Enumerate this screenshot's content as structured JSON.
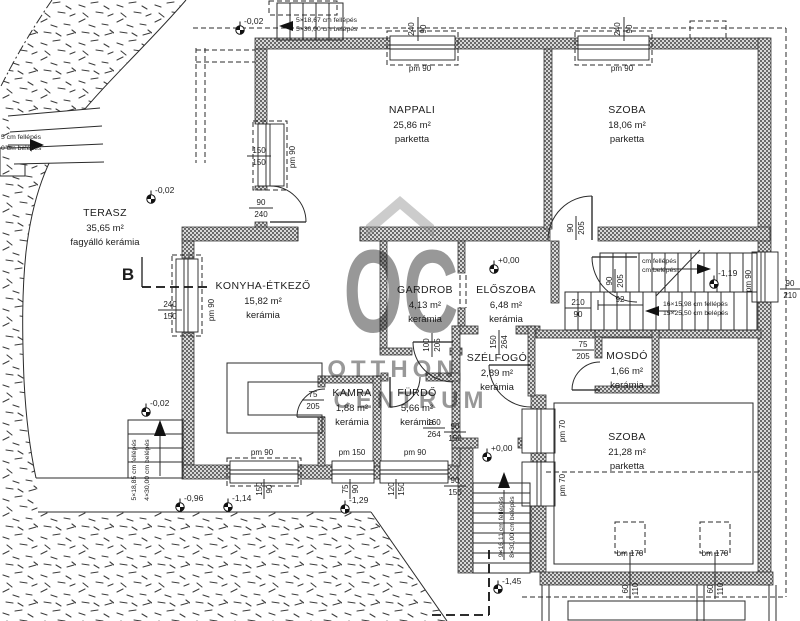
{
  "watermark": {
    "big": "OC",
    "line1": "OTTHON",
    "line2": "CENTRUM"
  },
  "section": {
    "label": "B"
  },
  "rooms": {
    "terasz": {
      "name": "TERASZ",
      "area": "35,65 m²",
      "floor": "fagyálló kerámia"
    },
    "nappali": {
      "name": "NAPPALI",
      "area": "25,86 m²",
      "floor": "parketta"
    },
    "szoba1": {
      "name": "SZOBA",
      "area": "18,06 m²",
      "floor": "parketta"
    },
    "konyha": {
      "name": "KONYHA-ÉTKEZŐ",
      "area": "15,82 m²",
      "floor": "kerámia"
    },
    "gardrob": {
      "name": "GARDROB",
      "area": "4,13 m²",
      "floor": "kerámia"
    },
    "eloszoba": {
      "name": "ELŐSZOBA",
      "area": "6,48 m²",
      "floor": "kerámia"
    },
    "szelfogo": {
      "name": "SZÉLFOGÓ",
      "area": "2,89 m²",
      "floor": "kerámia"
    },
    "mosdo": {
      "name": "MOSDÓ",
      "area": "1,66 m²",
      "floor": "kerámia"
    },
    "kamra": {
      "name": "KAMRA",
      "area": "1,88 m²",
      "floor": "kerámia"
    },
    "furdo": {
      "name": "FÜRDŐ",
      "area": "5,66 m²",
      "floor": "kerámia"
    },
    "szoba2": {
      "name": "SZOBA",
      "area": "21,28 m²",
      "floor": "parketta"
    }
  },
  "levels": {
    "top": "-0,02",
    "terasz": "-0,02",
    "corner": "-0,02",
    "eloszoba": "+0,00",
    "entry": "+0,00",
    "stair": "-1,19",
    "garden1": "-0,96",
    "garden2": "-1,14",
    "garden3": "-1,29",
    "garden4": "-1,45"
  },
  "stairs": {
    "top": {
      "l1": "5×18,67 cm fellépés",
      "l2": "5×30,00 cm belépés"
    },
    "left": {
      "l1": "5 cm fellépés",
      "l2": "0 cm belépés"
    },
    "corner": {
      "l1": "5×18,85 cm fellépés",
      "l2": "4×30,00 cm belépés"
    },
    "upper": {
      "l1": "cm fellépés",
      "l2": "cm belépés"
    },
    "lower": {
      "l1": "16×15,98 cm fellépés",
      "l2": "15×25,50 cm belépés"
    },
    "entry": {
      "l1": "9×16,11 cm fellépés",
      "l2": "8×30,00 cm belépés"
    }
  },
  "dims": {
    "w_top1": {
      "w": "240",
      "h": "90",
      "pm": "pm 90"
    },
    "w_top2": {
      "w": "240",
      "h": "90",
      "pm": "pm 90"
    },
    "w_nap": {
      "w": "150",
      "h": "150",
      "pm": "pm 90"
    },
    "d_nap": {
      "w": "90",
      "h": "240"
    },
    "w_kon": {
      "w": "240",
      "h": "150",
      "pm": "pm 90"
    },
    "d_szoba1": {
      "w": "90",
      "h": "205"
    },
    "d_gardrob": {
      "w": "100",
      "h": "205"
    },
    "d_stair": {
      "w": "90",
      "h": "205"
    },
    "open_elo": {
      "w": "210",
      "h": "90"
    },
    "dim92": "92",
    "w_right": {
      "w": "90",
      "h": "210",
      "pm": "pm 90"
    },
    "d_mosdo": {
      "w": "75",
      "h": "205"
    },
    "d_kamra": {
      "w": "75",
      "h": "205"
    },
    "w_konb": {
      "w": "150",
      "h": "90",
      "pm": "pm 90"
    },
    "w_kamrab": {
      "w": "75",
      "h": "90",
      "pm": "pm 150"
    },
    "w_furdob": {
      "w": "120",
      "h": "150",
      "pm": "pm 90"
    },
    "w_st1": {
      "w": "90",
      "h": "150",
      "pm": "pm 70"
    },
    "w_st2": {
      "w": "90",
      "h": "150",
      "pm": "pm 70"
    },
    "d_front_top": {
      "w": "150",
      "h": "264"
    },
    "d_front": {
      "w": "160",
      "h": "264"
    },
    "rw1": {
      "label": "bm 170",
      "w": "60",
      "h": "110"
    },
    "rw2": {
      "label": "bm 170",
      "w": "60",
      "h": "110"
    }
  }
}
